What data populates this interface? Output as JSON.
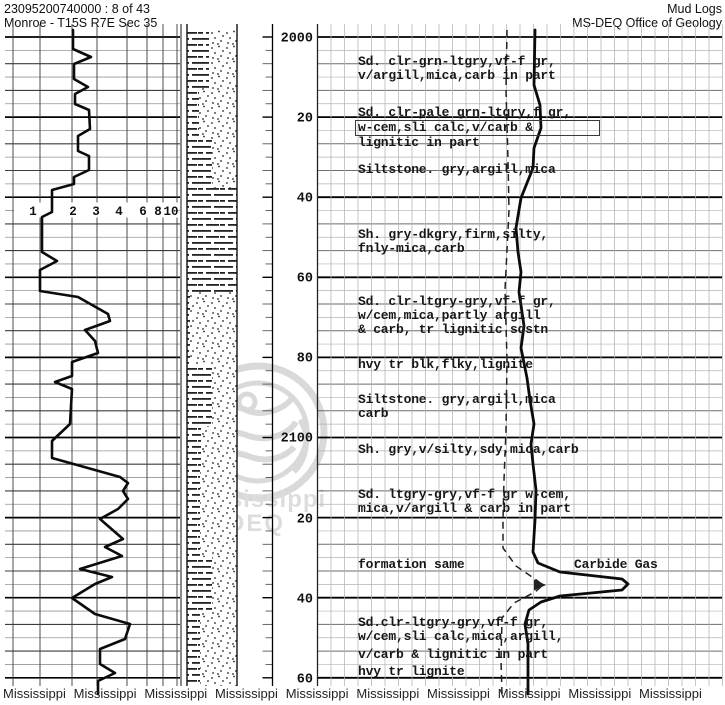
{
  "header": {
    "doc_id": "23095200740000 : 8 of 43",
    "location": "Monroe - T15S R7E Sec 35",
    "title": "Mud Logs",
    "office": "MS-DEQ Office of Geology"
  },
  "watermark": {
    "line1": "Mississippi",
    "line2": "DEQ"
  },
  "footer": {
    "text": "Mississippi",
    "repeat": 10
  },
  "scale_labels": [
    {
      "text": "1",
      "x": 33
    },
    {
      "text": "2",
      "x": 73
    },
    {
      "text": "3",
      "x": 96
    },
    {
      "text": "4",
      "x": 119
    },
    {
      "text": "6",
      "x": 143
    },
    {
      "text": "8",
      "x": 158
    },
    {
      "text": "10",
      "x": 171
    }
  ],
  "depth_labels": [
    {
      "text": "2000",
      "y": 37
    },
    {
      "text": "20",
      "y": 117
    },
    {
      "text": "40",
      "y": 197
    },
    {
      "text": "60",
      "y": 277
    },
    {
      "text": "80",
      "y": 357
    },
    {
      "text": "2100",
      "y": 437
    },
    {
      "text": "20",
      "y": 518
    },
    {
      "text": "40",
      "y": 598
    },
    {
      "text": "60",
      "y": 678
    }
  ],
  "descriptions": [
    {
      "top": 55,
      "lines": [
        "Sd. clr-grn-ltgry,vf-f gr,",
        "v/argill,mica,carb in part"
      ]
    },
    {
      "top": 106,
      "lines": [
        "Sd. clr-pale grn-ltgry,f gr,",
        "w-cem,sli calc,v/carb &",
        "lignitic in part"
      ],
      "boxed_line": 1
    },
    {
      "top": 163,
      "lines": [
        "Siltstone. gry,argill,mica"
      ]
    },
    {
      "top": 228,
      "lines": [
        "Sh. gry-dkgry,firm,silty,",
        "fnly-mica,carb"
      ]
    },
    {
      "top": 295,
      "lines": [
        "Sd. clr-ltgry-gry,vf-f gr,",
        "w/cem,mica,partly argill",
        "& carb, tr lignitic sdstn"
      ]
    },
    {
      "top": 358,
      "lines": [
        "hvy tr blk,flky,lignite"
      ]
    },
    {
      "top": 393,
      "lines": [
        "Siltstone. gry,argill,mica",
        "carb"
      ]
    },
    {
      "top": 443,
      "lines": [
        "Sh. gry,v/silty,sdy,mica,carb"
      ]
    },
    {
      "top": 488,
      "lines": [
        "Sd. ltgry-gry,vf-f gr w-cem,",
        "mica,v/argill & carb in part"
      ]
    },
    {
      "top": 558,
      "lines": [
        "formation same"
      ]
    },
    {
      "top": 616,
      "lines": [
        "Sd.clr-ltgry-gry,vf-f gr,",
        "w/cem,sli calc,mica,argill,"
      ]
    },
    {
      "top": 648,
      "lines": [
        "v/carb & lignitic in part"
      ]
    },
    {
      "top": 665,
      "lines": [
        "hvy tr lignite"
      ]
    }
  ],
  "gas_annotation": {
    "text": "Carbide Gas"
  },
  "lithology": {
    "column_x": 187,
    "column_width": 50,
    "bands": [
      {
        "top": 30,
        "bot": 88,
        "shale": 22
      },
      {
        "top": 88,
        "bot": 140,
        "shale": 12
      },
      {
        "top": 140,
        "bot": 188,
        "shale": 25
      },
      {
        "top": 188,
        "bot": 292,
        "shale": 50
      },
      {
        "top": 292,
        "bot": 365,
        "shale": 3
      },
      {
        "top": 365,
        "bot": 426,
        "shale": 25
      },
      {
        "top": 426,
        "bot": 470,
        "shale": 14
      },
      {
        "top": 470,
        "bot": 557,
        "shale": 13
      },
      {
        "top": 557,
        "bot": 612,
        "shale": 25
      },
      {
        "top": 612,
        "bot": 686,
        "shale": 13
      }
    ]
  },
  "curves": {
    "left_gas_curve": [
      [
        73,
        30
      ],
      [
        73,
        49
      ],
      [
        91,
        57
      ],
      [
        74,
        64
      ],
      [
        74,
        79
      ],
      [
        88,
        87
      ],
      [
        75,
        94
      ],
      [
        75,
        104
      ],
      [
        89,
        110
      ],
      [
        90,
        129
      ],
      [
        78,
        136
      ],
      [
        78,
        151
      ],
      [
        89,
        156
      ],
      [
        89,
        170
      ],
      [
        74,
        177
      ],
      [
        74,
        184
      ],
      [
        52,
        190
      ],
      [
        52,
        212
      ],
      [
        42,
        217
      ],
      [
        42,
        252
      ],
      [
        57,
        261
      ],
      [
        40,
        270
      ],
      [
        40,
        291
      ],
      [
        78,
        297
      ],
      [
        108,
        314
      ],
      [
        110,
        321
      ],
      [
        85,
        330
      ],
      [
        95,
        341
      ],
      [
        98,
        353
      ],
      [
        72,
        362
      ],
      [
        72,
        376
      ],
      [
        55,
        382
      ],
      [
        72,
        389
      ],
      [
        70,
        424
      ],
      [
        52,
        441
      ],
      [
        52,
        458
      ],
      [
        70,
        463
      ],
      [
        120,
        477
      ],
      [
        128,
        483
      ],
      [
        123,
        491
      ],
      [
        128,
        499
      ],
      [
        118,
        509
      ],
      [
        100,
        519
      ],
      [
        123,
        539
      ],
      [
        105,
        547
      ],
      [
        122,
        556
      ],
      [
        80,
        569
      ],
      [
        112,
        577
      ],
      [
        95,
        584
      ],
      [
        72,
        598
      ],
      [
        95,
        614
      ],
      [
        130,
        624
      ],
      [
        125,
        639
      ],
      [
        100,
        649
      ],
      [
        100,
        664
      ],
      [
        115,
        673
      ],
      [
        98,
        681
      ],
      [
        98,
        694
      ]
    ],
    "total_gas_curve": [
      [
        535,
        30
      ],
      [
        534,
        85
      ],
      [
        540,
        105
      ],
      [
        541,
        128
      ],
      [
        534,
        148
      ],
      [
        533,
        168
      ],
      [
        521,
        198
      ],
      [
        516,
        228
      ],
      [
        518,
        252
      ],
      [
        521,
        272
      ],
      [
        519,
        292
      ],
      [
        522,
        312
      ],
      [
        524,
        326
      ],
      [
        521,
        348
      ],
      [
        527,
        378
      ],
      [
        530,
        400
      ],
      [
        534,
        424
      ],
      [
        531,
        444
      ],
      [
        533,
        464
      ],
      [
        536,
        490
      ],
      [
        535,
        520
      ],
      [
        533,
        552
      ],
      [
        538,
        563
      ],
      [
        560,
        572
      ],
      [
        622,
        579
      ],
      [
        628,
        584
      ],
      [
        622,
        590
      ],
      [
        560,
        596
      ],
      [
        541,
        602
      ],
      [
        529,
        610
      ],
      [
        525,
        624
      ],
      [
        528,
        644
      ],
      [
        528,
        694
      ]
    ],
    "dashed_curve": [
      [
        507,
        30
      ],
      [
        506,
        90
      ],
      [
        508,
        160
      ],
      [
        509,
        210
      ],
      [
        505,
        290
      ],
      [
        507,
        360
      ],
      [
        506,
        430
      ],
      [
        504,
        480
      ],
      [
        503,
        520
      ],
      [
        503,
        548
      ],
      [
        516,
        566
      ],
      [
        535,
        579
      ],
      [
        543,
        585
      ],
      [
        535,
        592
      ],
      [
        514,
        603
      ],
      [
        502,
        618
      ],
      [
        501,
        660
      ],
      [
        502,
        694
      ]
    ]
  },
  "colors": {
    "paper": "#ffffff",
    "ink": "#111111",
    "grid_minor": "#b3b3b3",
    "grid_mid": "#6e6e6e",
    "grid_major": "#000000",
    "watermark_gray": "#bdbdbd"
  }
}
